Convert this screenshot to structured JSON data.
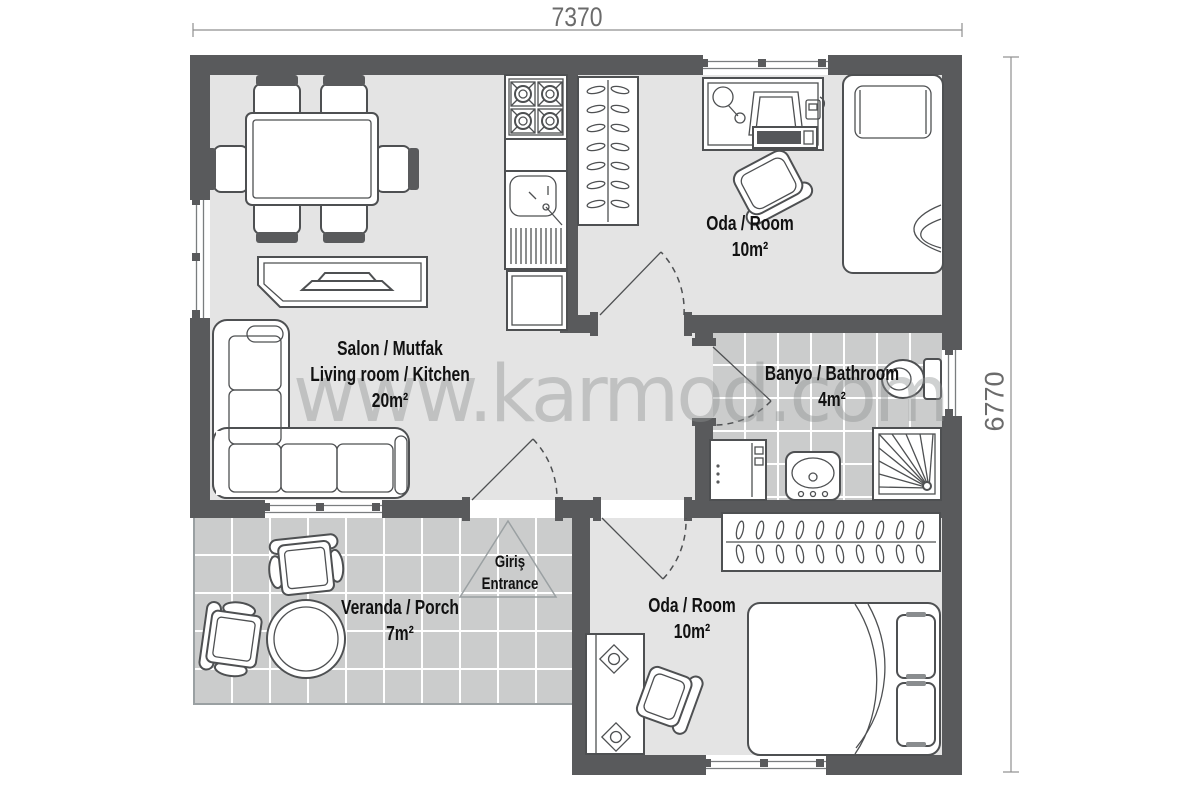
{
  "dimensions": {
    "top": "7370",
    "right": "6770"
  },
  "watermark": "www.karmod.com",
  "rooms": {
    "living": {
      "line1": "Salon / Mutfak",
      "line2": "Living room / Kitchen",
      "area": "20m²"
    },
    "bedroom_top": {
      "line1": "Oda / Room",
      "area": "10m²"
    },
    "bathroom": {
      "line1": "Banyo / Bathroom",
      "area": "4m²"
    },
    "bedroom_bottom": {
      "line1": "Oda / Room",
      "area": "10m²"
    },
    "veranda": {
      "line1": "Veranda / Porch",
      "area": "7m²"
    },
    "entrance": {
      "line1": "Giriş",
      "line2": "Entrance"
    }
  },
  "colors": {
    "wall": "#595a5c",
    "room_floor": "#e4e4e4",
    "tile_floor": "#cbcccc",
    "outline": "#4e5052",
    "label": "#111111",
    "dimension": "#6b6b6b",
    "watermark": "#8f9292"
  }
}
